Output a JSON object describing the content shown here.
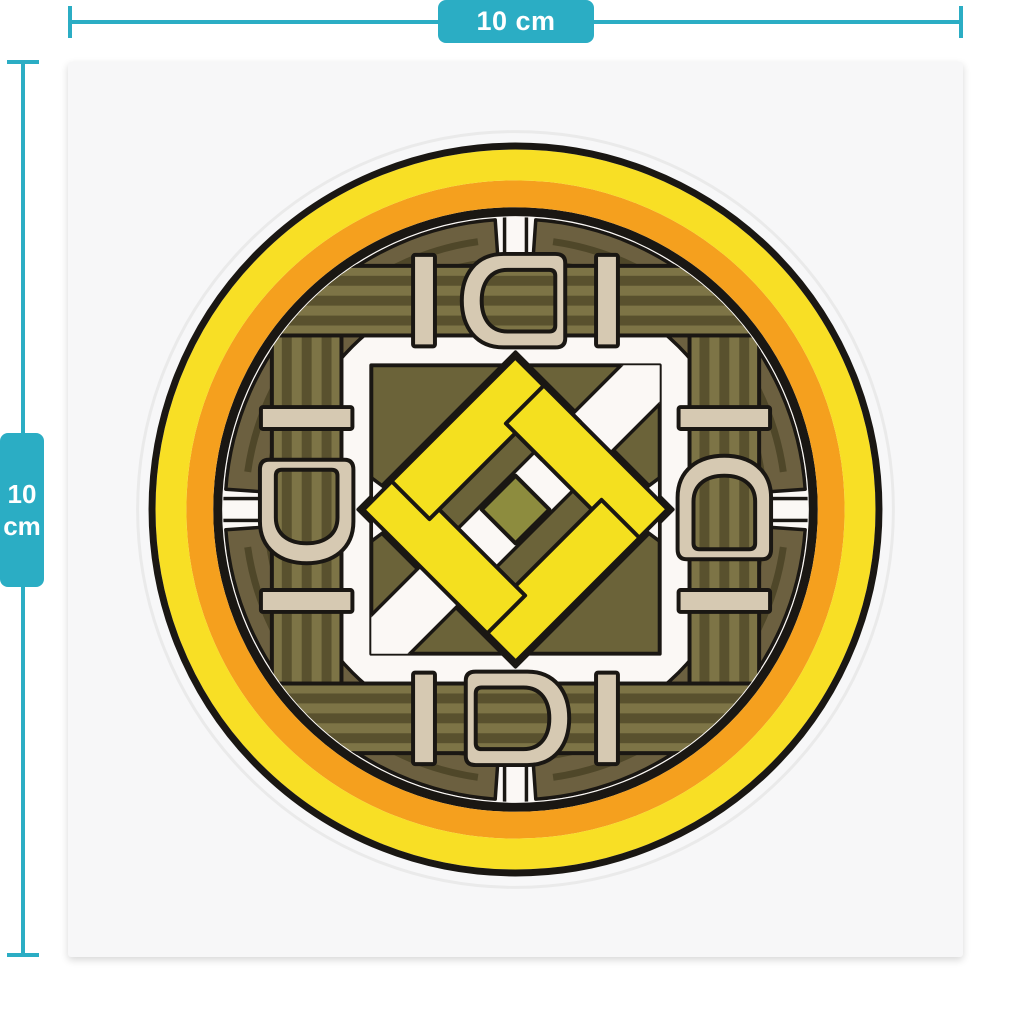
{
  "product_preview": {
    "sticker": {
      "shape": "square",
      "background_color": "#f7f7f8",
      "die_cut_line_color": "#eaeaea"
    },
    "rulers": {
      "accent_color": "#2badc4",
      "top": {
        "label": "10 cm"
      },
      "left": {
        "value": "10",
        "unit": "cm"
      }
    },
    "emblem": {
      "description": "circular belt-and-buckle emblem with woven knot center",
      "colors": {
        "ring_outline": "#1a1713",
        "ring_yellow": "#f8df25",
        "ring_orange": "#f5a01e",
        "belt_light": "#7d7446",
        "belt_dark": "#59512e",
        "corner_band": "#6c6040",
        "corner_band_stripe": "#4f4729",
        "buckle_beige": "#d6c9b2",
        "center_square": "#6b6339",
        "diamond_ring_brown": "#6f4a40",
        "knot_yellow": "#f4e01f",
        "core_olive": "#8d8c3e",
        "interior_white": "#fbf8f5"
      }
    }
  }
}
